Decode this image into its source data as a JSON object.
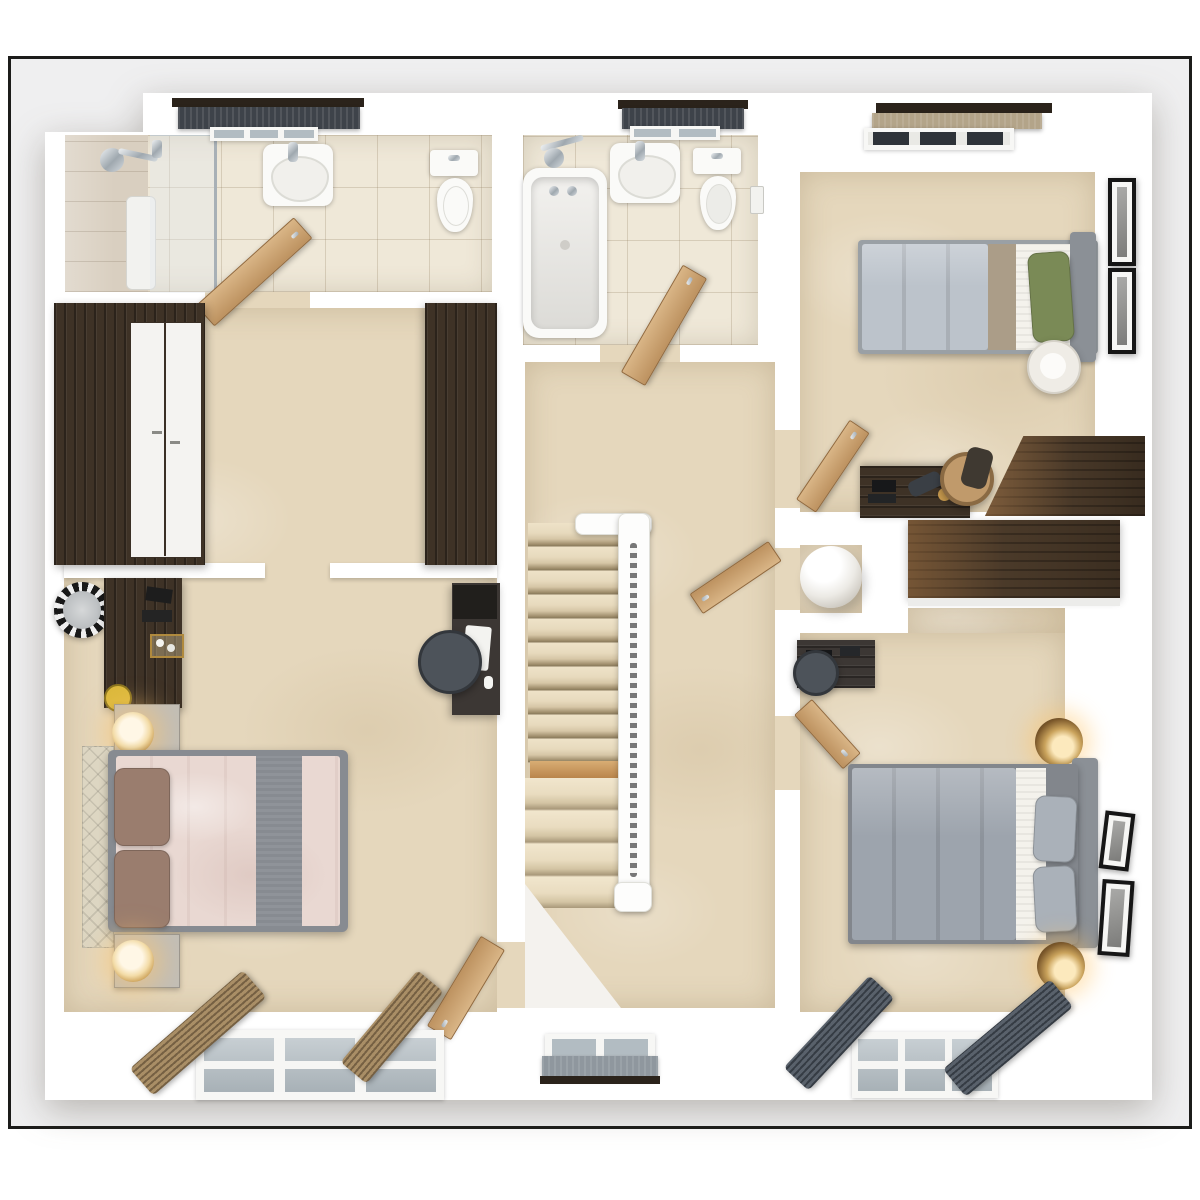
{
  "scene": {
    "kind": "3d-top-down-floor-plan-render",
    "floor_label": "",
    "visible_text": "none"
  },
  "frame": {
    "border_color": "#1c1c1a",
    "margin_color": "#ffffff"
  },
  "palette": {
    "backdrop": "#efeff0",
    "wall": "#ffffff",
    "carpet": "#e5d7bc",
    "tileFloor": "#efe8d8",
    "wallTile": "#d9cfc0",
    "darkWood": "#3e3226",
    "mediumWood": "#55422f",
    "oakDoor": "#c69a63",
    "porcelain": "#fafaf8",
    "chrome": "#aab3ba",
    "windowGlass": "#b2bcc2",
    "pelmet": "#2b231b",
    "blindDark": "#3e434a",
    "blindGrey": "#8f979e",
    "blindKhaki": "#b3a489",
    "curtainTan": "#a98e66",
    "curtainGrey": "#59616b",
    "duvetBlush": "#e9d8d2",
    "runnerGrey": "#878b91",
    "pillowBrown": "#9a7d6e",
    "headboardCream": "#ddd6c2",
    "duvetLightGrey": "#bcc3cb",
    "bandTaupe": "#ab9d88",
    "sheetWhite": "#f4f2ec",
    "pillowGreen": "#7a8a56",
    "headboardGrey": "#8b9096",
    "duvetGrey": "#9da4ad",
    "pillowGrey": "#aab1b9",
    "bedFrameGrey": "#9aa0a5",
    "bedFrameGrey3": "#82868c",
    "deskDark": "#3c3734",
    "chairGrey": "#4d535a",
    "chairWood": "#c09a6b",
    "gold": "#c89a4e",
    "stairCarpet": "#e8dcc2",
    "woodStep": "#c79e66",
    "lampWhite": "#efece6",
    "cylinderWhite": "#e9e7e2",
    "pictureFrame": "#161616",
    "candleYellow": "#dcb93c",
    "nightstandGrey": "#c2beb6"
  },
  "rooms": [
    {
      "name": "en-suite",
      "floor": "tile",
      "fixtures": [
        "shower-enclosure",
        "shower-fixture",
        "washbasin",
        "toilet",
        "window-dark-roller-blind",
        "open-door"
      ]
    },
    {
      "name": "dressing-area",
      "floor": "carpet",
      "fixtures": [
        "dark-wardrobe-left-with-white-doors",
        "dark-wardrobe-right"
      ]
    },
    {
      "name": "master-bedroom",
      "floor": "carpet",
      "fixtures": [
        "double-bed-blush-duvet-grey-runner",
        "cream-headboard",
        "two-brown-pillows",
        "two-nightstands",
        "two-gold-table-lamps",
        "dressing-table",
        "round-mirror",
        "candle",
        "desk",
        "desk-chair",
        "keyboard",
        "window-six-panes",
        "two-tan-curtains",
        "open-door"
      ]
    },
    {
      "name": "bathroom",
      "floor": "tile",
      "fixtures": [
        "bathtub",
        "shower-mixer",
        "washbasin",
        "toilet",
        "toilet-roll-holder",
        "window-dark-roller-blind",
        "open-door"
      ]
    },
    {
      "name": "landing",
      "floor": "carpet",
      "fixtures": [
        "staircase-upper-flight",
        "wood-step",
        "staircase-lower-flight",
        "white-banister",
        "newel-post",
        "window-grey-roller-blind",
        "airing-cupboard-open-door"
      ]
    },
    {
      "name": "bedroom-2",
      "floor": "carpet",
      "fixtures": [
        "single-bed-grey-duvet",
        "taupe-runner",
        "green-pillow",
        "grey-headboard",
        "round-floor-lamp",
        "desk-with-lamp",
        "wooden-chair",
        "corner-fitted-wardrobe",
        "two-picture-frames",
        "window-khaki-blind",
        "open-door"
      ]
    },
    {
      "name": "airing-cupboard",
      "floor": "carpet",
      "fixtures": [
        "hot-water-cylinder"
      ]
    },
    {
      "name": "bedroom-3",
      "floor": "carpet",
      "fixtures": [
        "double-bed-grey-duvet",
        "two-grey-pillows",
        "grey-headboard",
        "two-brass-wall-lamps",
        "long-fitted-wardrobe",
        "desk",
        "desk-chair",
        "two-picture-frames",
        "window-six-panes",
        "two-dark-grey-curtains",
        "open-door"
      ]
    }
  ]
}
